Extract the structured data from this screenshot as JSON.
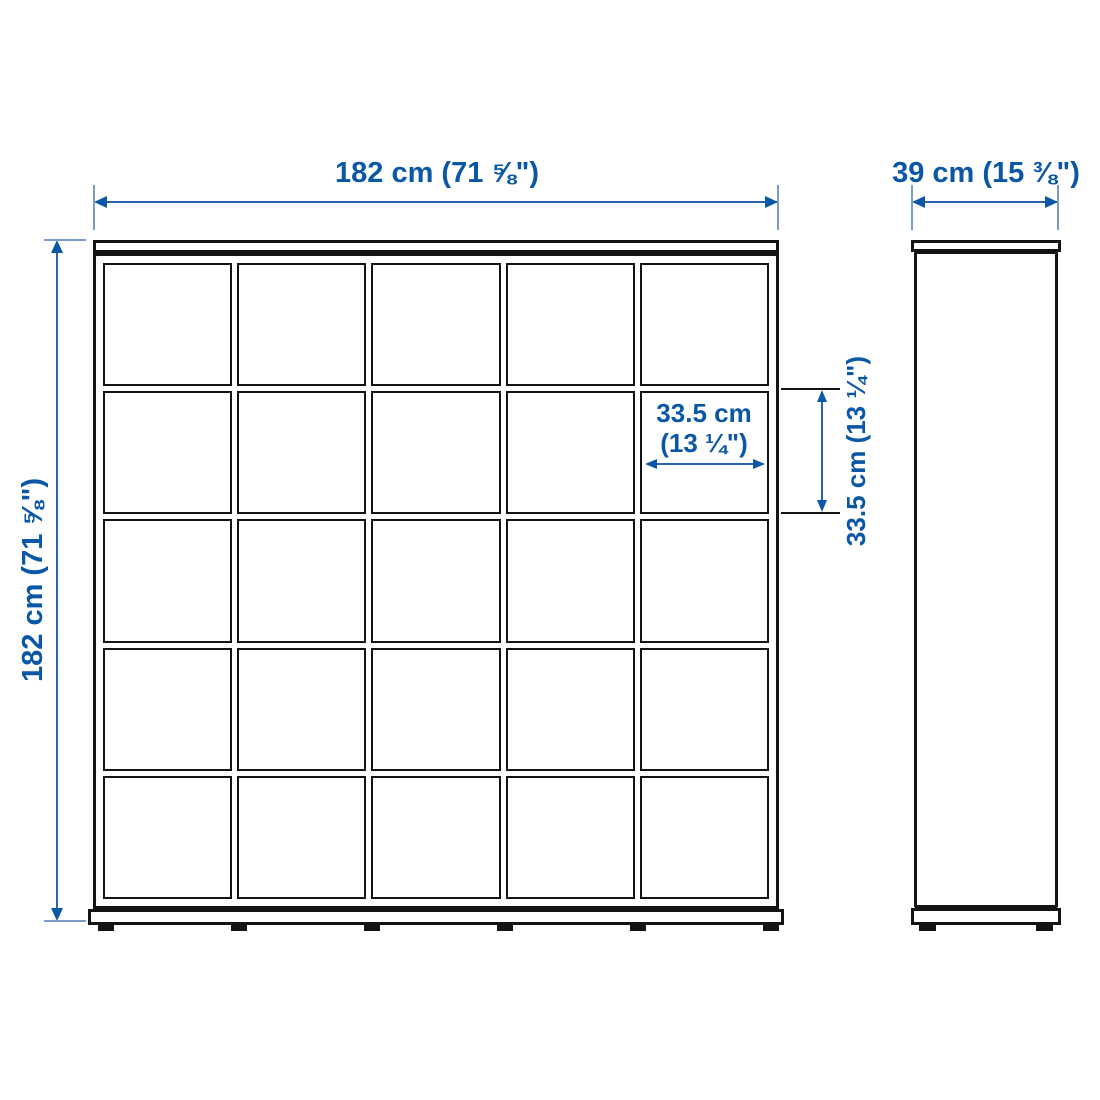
{
  "colors": {
    "accent_blue": "#0a57a5",
    "line_black": "#141414",
    "background": "#ffffff"
  },
  "diagram": {
    "kind": "furniture-dimension-drawing",
    "front_view": {
      "grid_rows": 5,
      "grid_cols": 5
    },
    "labels": {
      "overall_width": "182 cm (71 ⅝\")",
      "overall_height": "182 cm (71 ⅝\")",
      "depth": "39 cm (15 ⅜\")",
      "cell_width_line1": "33.5 cm",
      "cell_width_line2": "(13 ¼\")",
      "cell_height": "33.5 cm (13 ¼\")"
    }
  }
}
